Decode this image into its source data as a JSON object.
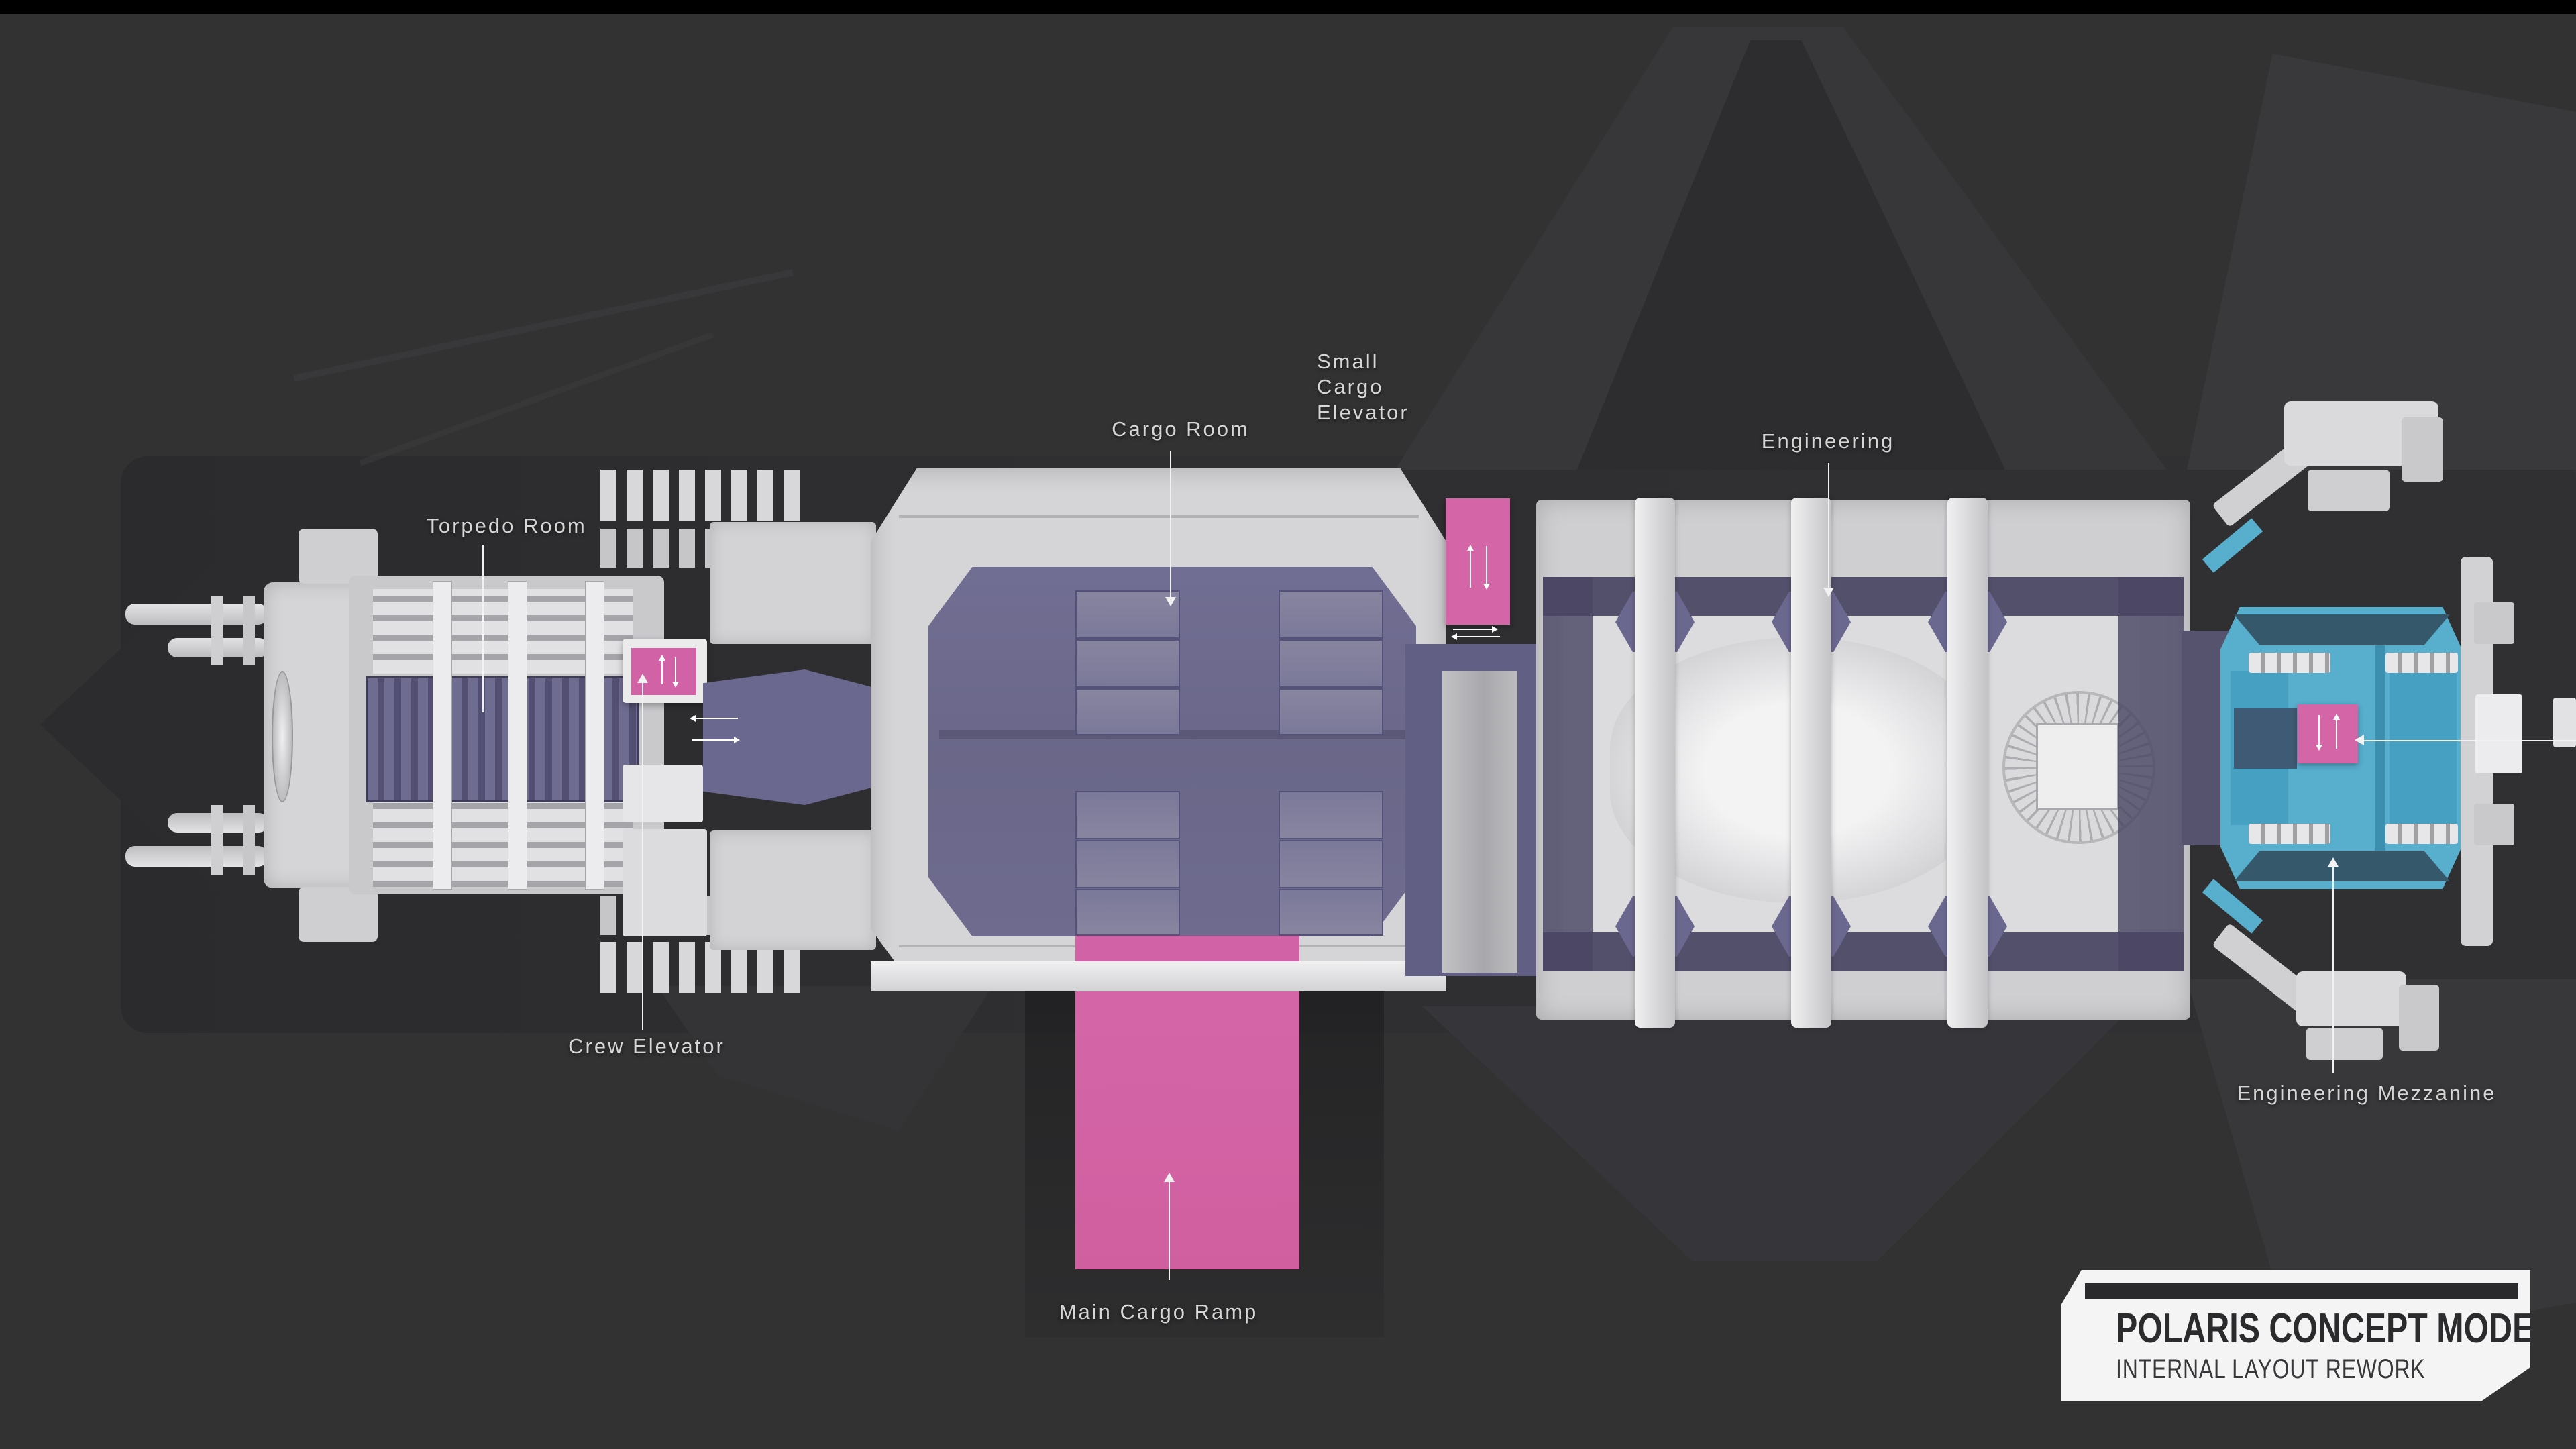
{
  "page": {
    "background_color": "#323233",
    "top_bar_color": "#000000"
  },
  "badge": {
    "title": "POLARIS CONCEPT MODEL",
    "subtitle": "INTERNAL LAYOUT REWORK"
  },
  "labels": {
    "torpedo_room": "Torpedo Room",
    "crew_elevator": "Crew Elevator",
    "cargo_room": "Cargo Room",
    "small_cargo_elevator": {
      "lines": [
        "Small",
        "Cargo",
        "Elevator"
      ]
    },
    "engineering": "Engineering",
    "engineering_mezzanine": "Engineering Mezzanine",
    "main_cargo_ramp": "Main Cargo Ramp"
  },
  "colors": {
    "highlight_pink": "#d162a6",
    "highlight_cyan": "#57aecd",
    "room_purple": "#6e6b8f",
    "room_purple_dark": "#47445e",
    "hull_gray": "#d5d5d7",
    "label_text": "#d6d6d6"
  },
  "icons": {
    "elevator_up_arrow": "↑",
    "elevator_down_arrow": "↓",
    "passage_left_arrow": "←",
    "passage_right_arrow": "→",
    "leader_up_arrow": "↑",
    "leader_down_arrow": "↓"
  }
}
